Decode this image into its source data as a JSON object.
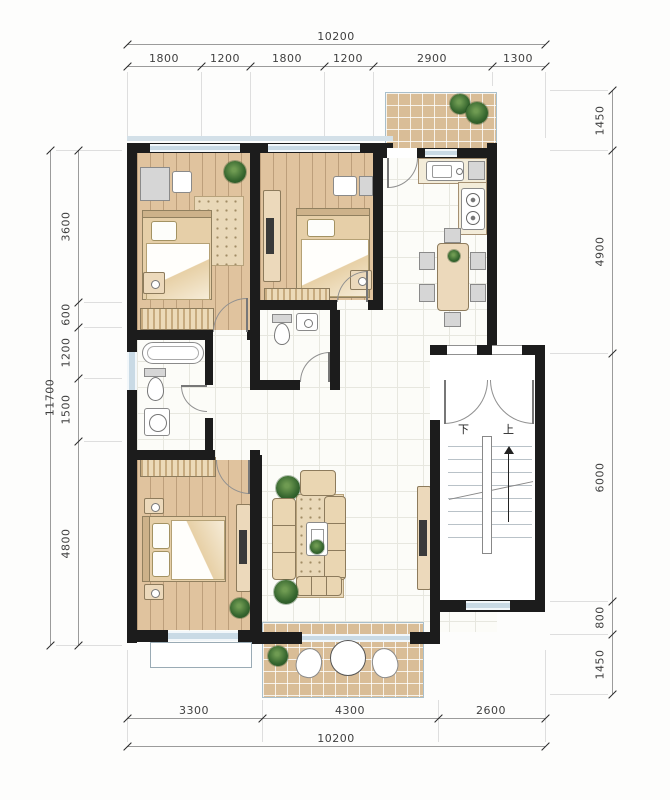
{
  "dimensions": {
    "top": {
      "total": "10200",
      "segments": [
        "1800",
        "1200",
        "1800",
        "1200",
        "2900",
        "1300"
      ]
    },
    "bottom": {
      "total": "10200",
      "segments": [
        "3300",
        "4300",
        "2600"
      ]
    },
    "left": {
      "total": "11700",
      "segments": [
        "3600",
        "600",
        "1200",
        "1500",
        "4800"
      ]
    },
    "right": {
      "segments": [
        "1450",
        "4900",
        "6000",
        "800",
        "1450"
      ]
    }
  },
  "stairs": {
    "down_label": "下",
    "up_label": "上"
  },
  "colors": {
    "wall": "#1c1c1c",
    "wood_floor": "#e0c39e",
    "tan_tile": "#d9bd97",
    "white_tile": "#fcfcf8",
    "window_blue": "#c9dae5",
    "furniture_tan": "#ecd9bb",
    "plant_green": "#35652e",
    "dimension_text": "#3f3f3f"
  }
}
